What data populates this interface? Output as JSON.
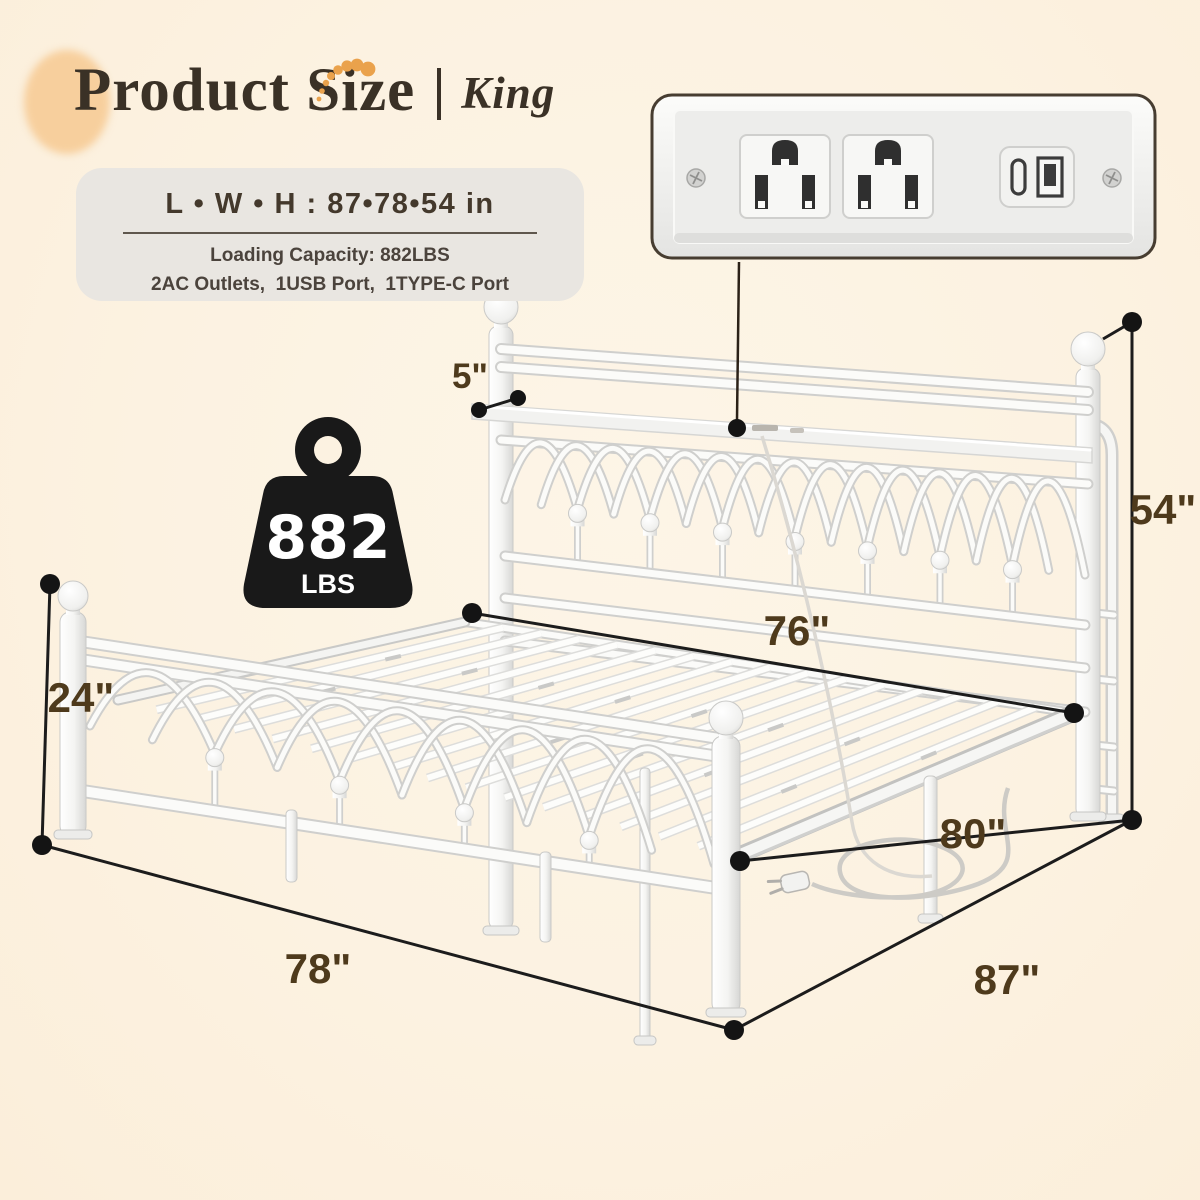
{
  "header": {
    "title": "Product Size",
    "divider": "|",
    "variant": "King"
  },
  "spec_card": {
    "dimensions": "L • W • H : 87•78•54 in",
    "capacity": "Loading Capacity: 882LBS",
    "ports": "2AC Outlets,  1USB Port,  1TYPE-C Port"
  },
  "weight_badge": {
    "value": "882",
    "unit": "LBS"
  },
  "dimensions": {
    "shelf_depth": "5\"",
    "total_height": "54\"",
    "slat_width": "76\"",
    "footboard_height": "24\"",
    "frame_width": "78\"",
    "side_length": "80\"",
    "total_length": "87\""
  },
  "icons": {
    "weight_icon": "kettlebell-weight",
    "ac_outlet_icon": "us-power-outlet",
    "usb_c_icon": "usb-type-c-port",
    "usb_a_icon": "usb-type-a-port",
    "screw_icon": "panel-screw",
    "plug_icon": "power-plug-with-cord",
    "sparkle_icon": "orange-dot-swoosh"
  },
  "colors": {
    "background": "#fcf2e1",
    "accent_orange": "#eaa24c",
    "peach_blob": "#f7cf9d",
    "title_brown": "#3a3126",
    "label_brown": "#4e3a1c",
    "card_bg": "#e9e6e1",
    "card_text": "#44392c",
    "bed_white": "#fbfbf9",
    "bed_shade": "#d2d2d0",
    "dimension_line": "#1c1c1c",
    "badge_black": "#191919"
  }
}
